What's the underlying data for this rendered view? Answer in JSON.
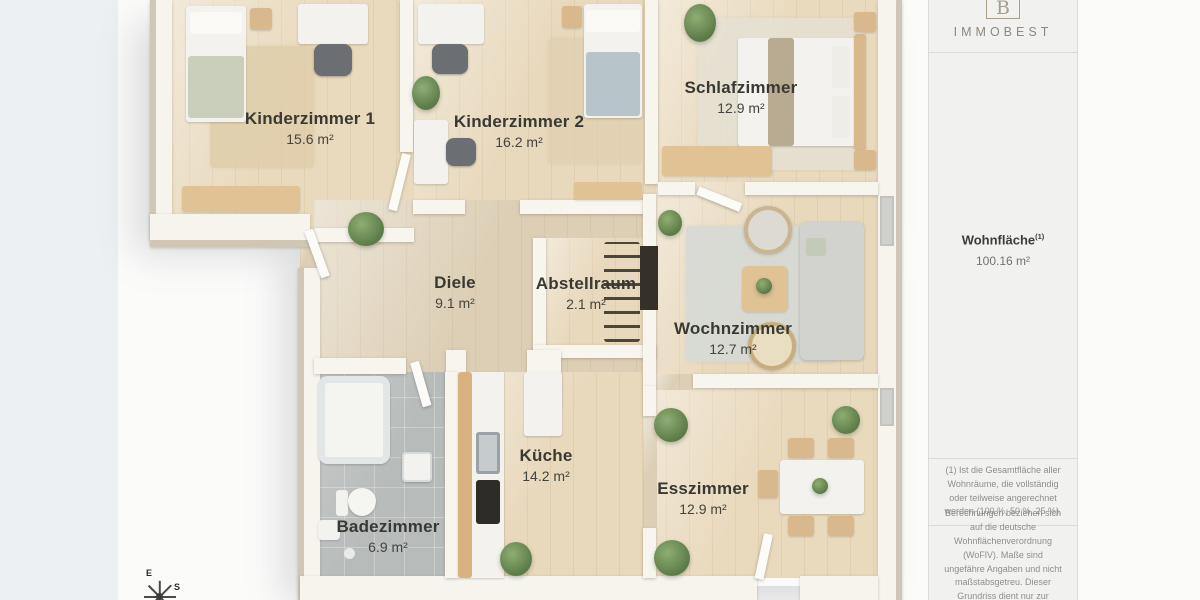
{
  "rooms": [
    {
      "id": "kinderzimmer-1",
      "name": "Kinderzimmer 1",
      "area": "15.6 m²"
    },
    {
      "id": "kinderzimmer-2",
      "name": "Kinderzimmer 2",
      "area": "16.2 m²"
    },
    {
      "id": "schlafzimmer",
      "name": "Schlafzimmer",
      "area": "12.9 m²"
    },
    {
      "id": "diele",
      "name": "Diele",
      "area": "9.1 m²"
    },
    {
      "id": "abstellraum",
      "name": "Abstellraum",
      "area": "2.1 m²"
    },
    {
      "id": "wochnzimmer",
      "name": "Wochnzimmer",
      "area": "12.7 m²"
    },
    {
      "id": "kueche",
      "name": "Küche",
      "area": "14.2 m²"
    },
    {
      "id": "esszimmer",
      "name": "Esszimmer",
      "area": "12.9 m²"
    },
    {
      "id": "badezimmer",
      "name": "Badezimmer",
      "area": "6.9 m²"
    }
  ],
  "sidebar": {
    "brand": "IMMOBEST",
    "logo_letter": "B",
    "area_label": "Wohnfläche",
    "area_sup": "(1)",
    "area_value": "100.16 m²",
    "footnote": "(1) Ist die Gesamtfläche aller Wohnräume, die vollständig oder teilweise angerechnet werden (100 %, 50 %, 25 %).",
    "disclaimer": "Berechnungen beziehen sich auf die deutsche Wohnflächenverordnung (WoFlV). Maße sind ungefähre Angaben und nicht maßstabsgetreu. Dieser Grundriss dient nur zur Veranschaulichung."
  },
  "compass": {
    "labels": [
      "E",
      "S"
    ]
  },
  "colors": {
    "wood_floor": "#e8d8bc",
    "wall_side": "#cfc6b6",
    "tile_floor": "#b7bbba",
    "brand_accent": "#a89e8e",
    "label_text": "#393934",
    "background_strip": "#edf0f2"
  }
}
